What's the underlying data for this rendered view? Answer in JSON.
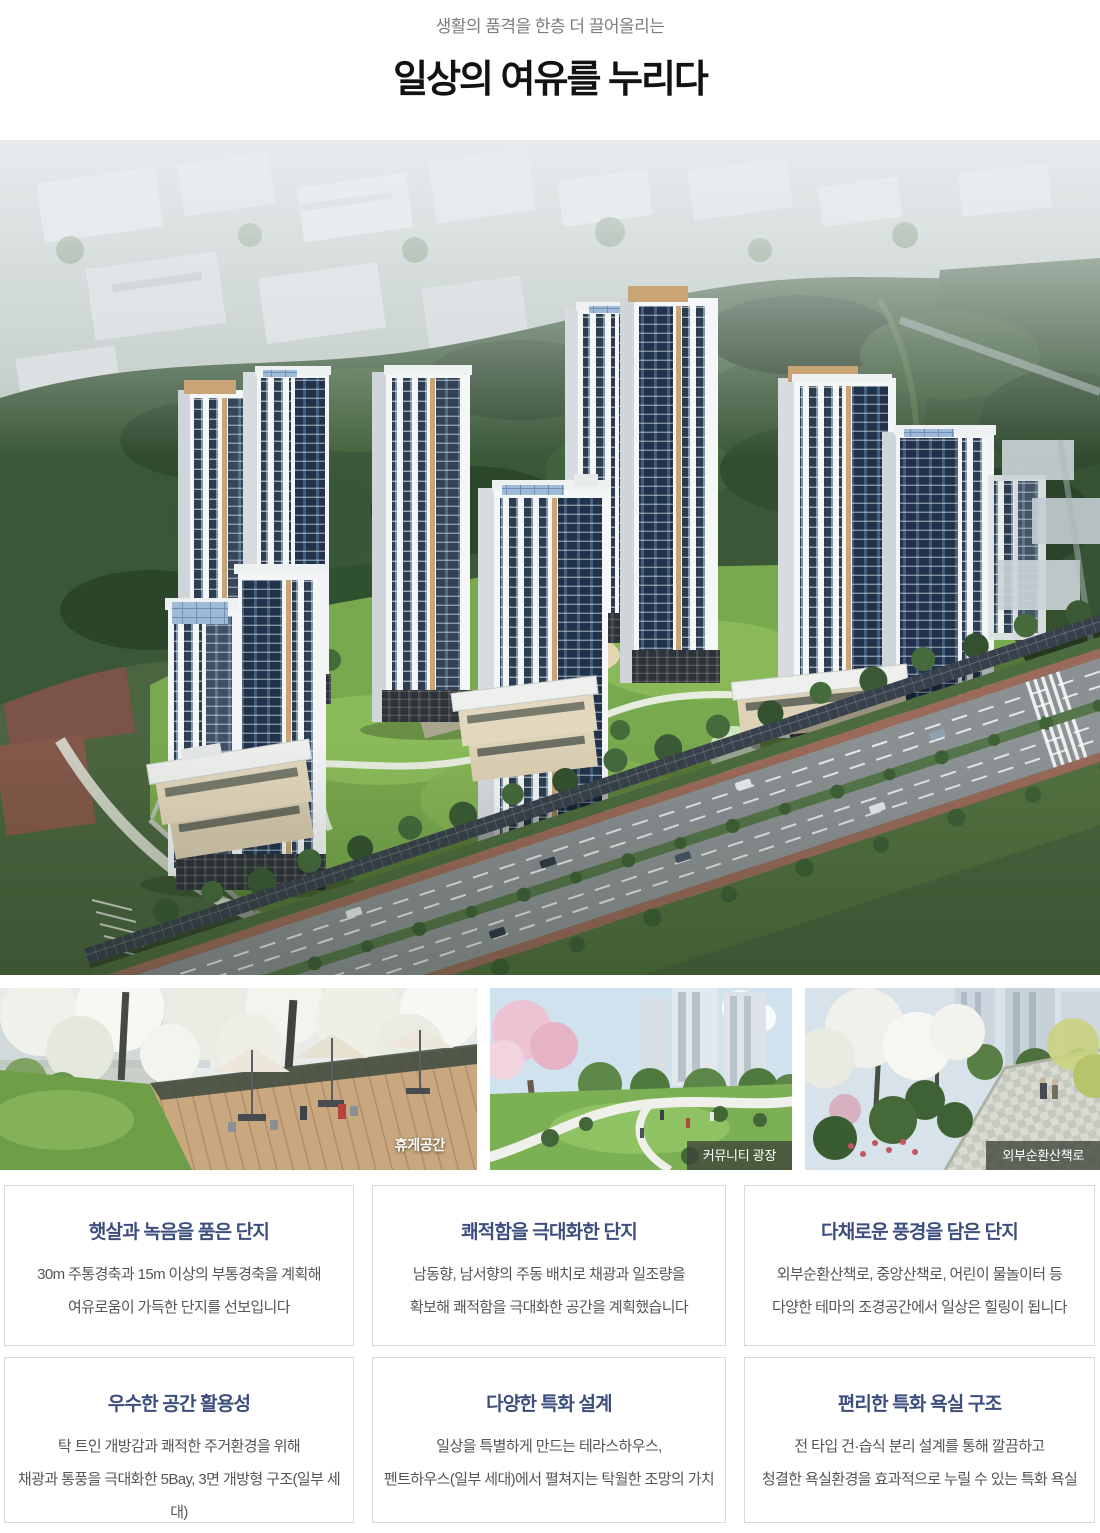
{
  "header": {
    "subtitle": "생활의 품격을 한층 더 끌어올리는",
    "title": "일상의 여유를 누리다"
  },
  "hero": {
    "description": "아파트 단지 조감도"
  },
  "photos": {
    "items": [
      {
        "label": "휴게공간"
      },
      {
        "label": "커뮤니티 광장"
      },
      {
        "label": "외부순환산책로"
      }
    ]
  },
  "cards": {
    "items": [
      {
        "title": "햇살과 녹음을 품은 단지",
        "line1": "30m 주통경축과 15m 이상의 부통경축을 계획해",
        "line2": "여유로움이 가득한 단지를 선보입니다"
      },
      {
        "title": "쾌적함을 극대화한 단지",
        "line1": "남동향, 남서향의 주동 배치로 채광과 일조량을",
        "line2": "확보해 쾌적함을 극대화한 공간을 계획했습니다"
      },
      {
        "title": "다채로운 풍경을 담은 단지",
        "line1": "외부순환산책로, 중앙산책로, 어린이 물놀이터 등",
        "line2": "다양한 테마의 조경공간에서 일상은 힐링이 됩니다"
      },
      {
        "title": "우수한 공간 활용성",
        "line1": "탁 트인 개방감과 쾌적한 주거환경을 위해",
        "line2": "채광과 통풍을 극대화한 5Bay, 3면 개방형 구조(일부 세대)"
      },
      {
        "title": "다양한 특화 설계",
        "line1": "일상을 특별하게 만드는 테라스하우스,",
        "line2": "펜트하우스(일부 세대)에서 펼쳐지는 탁월한 조망의 가치"
      },
      {
        "title": "편리한 특화 욕실 구조",
        "line1": "전 타입 건·습식 분리 설계를 통해 깔끔하고",
        "line2": "청결한 욕실환경을 효과적으로 누릴 수 있는 특화 욕실"
      }
    ]
  },
  "colors": {
    "card_title": "#3d4e7e",
    "body_text": "#555555",
    "subtitle_text": "#7d7d7d",
    "title_text": "#121212",
    "card_border": "#d9d9d9",
    "photo_badge_bg": "rgba(62,68,56,0.78)",
    "photo_badge_text": "#ffffff"
  }
}
